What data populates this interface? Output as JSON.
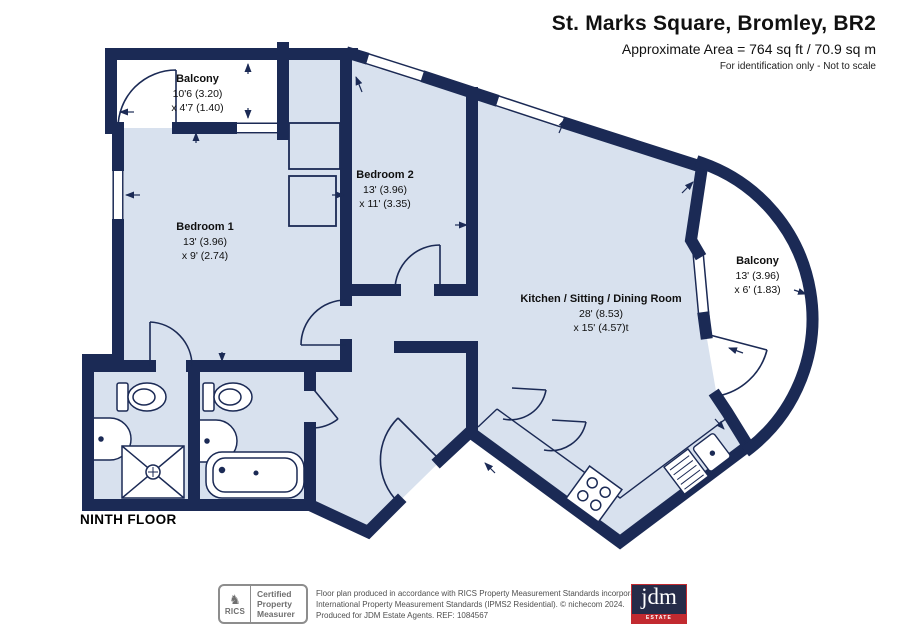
{
  "header": {
    "title": "St. Marks Square, Bromley, BR2",
    "area": "Approximate Area = 764 sq ft / 70.9 sq m",
    "note": "For identification only - Not to scale"
  },
  "plan": {
    "floor_label": "NINTH FLOOR",
    "rooms": [
      {
        "id": "balcony-top",
        "name": "Balcony",
        "dim1": "10'6 (3.20)",
        "dim2": "x 4'7 (1.40)"
      },
      {
        "id": "bedroom-1",
        "name": "Bedroom 1",
        "dim1": "13' (3.96)",
        "dim2": "x 9' (2.74)"
      },
      {
        "id": "bedroom-2",
        "name": "Bedroom 2",
        "dim1": "13' (3.96)",
        "dim2": "x 11' (3.35)"
      },
      {
        "id": "kitchen-sitting-dining",
        "name": "Kitchen / Sitting / Dining Room",
        "dim1": "28' (8.53)",
        "dim2": "x 15' (4.57)t"
      },
      {
        "id": "balcony-right",
        "name": "Balcony",
        "dim1": "13' (3.96)",
        "dim2": "x 6' (1.83)"
      }
    ]
  },
  "footer": {
    "rics": {
      "brand": "RICS",
      "lion_glyph": "♞",
      "lines": [
        "Certified",
        "Property",
        "Measurer"
      ]
    },
    "disclaimer": [
      "Floor plan produced in accordance with RICS Property Measurement Standards incorporating",
      "International Property Measurement Standards (IPMS2 Residential).   © nichecom 2024.",
      "Produced for JDM Estate Agents.   REF: 1084567"
    ],
    "agent": {
      "name": "jdm",
      "tagline": "ESTATE AGENTS"
    }
  },
  "colors": {
    "wall": "#1b2a55",
    "room_fill": "#d8e1ee",
    "agent_red": "#c22a30",
    "rics_gray": "#6f6f6f"
  }
}
